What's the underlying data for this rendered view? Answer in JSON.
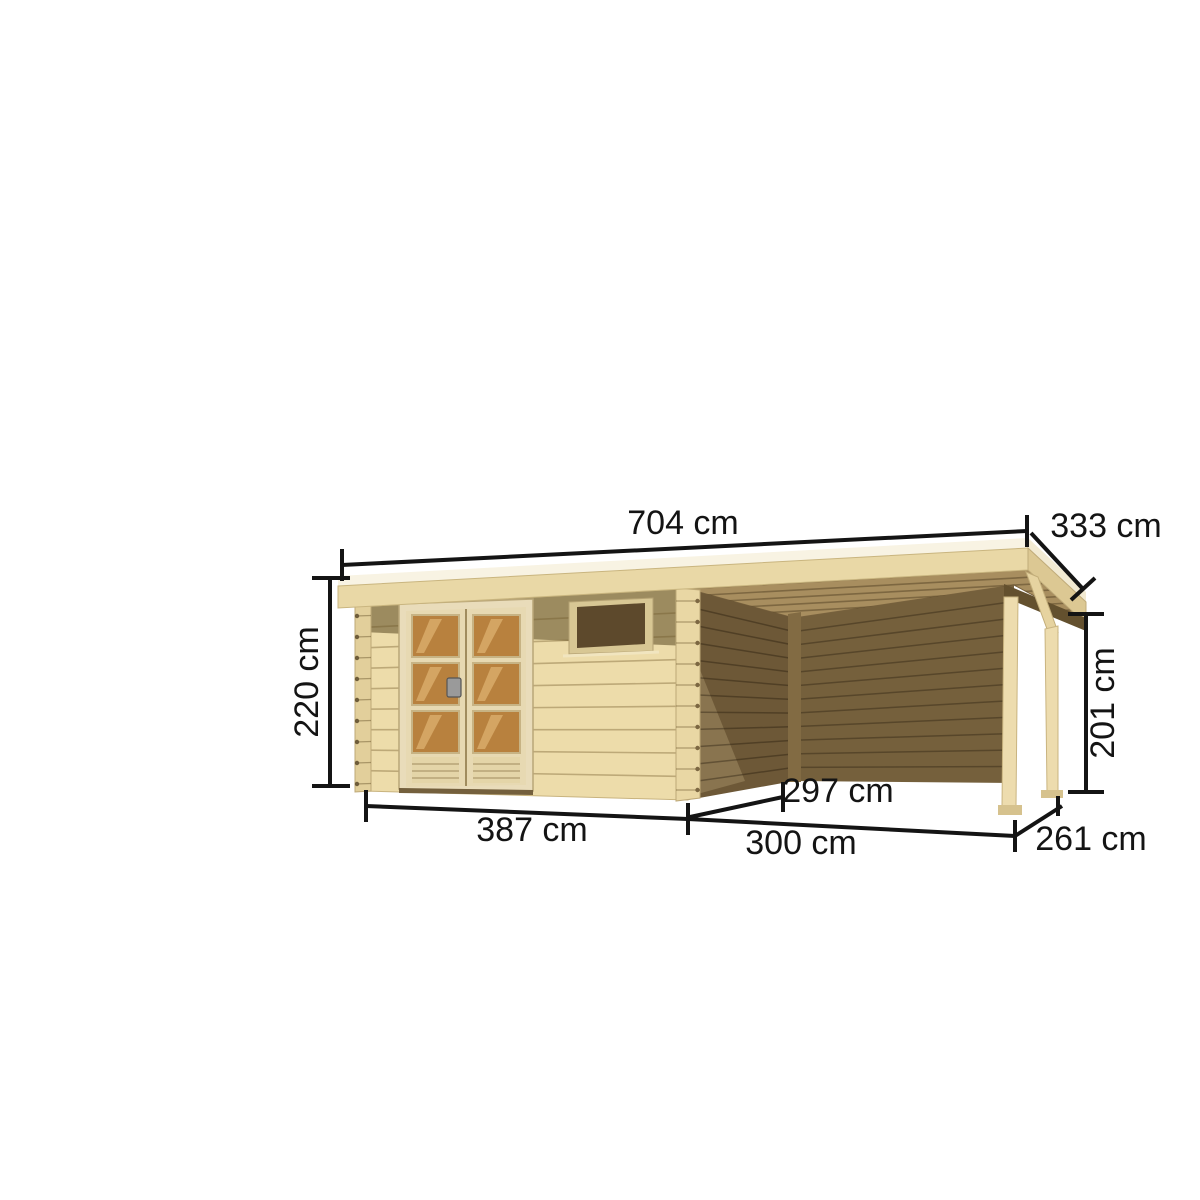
{
  "figure": {
    "type": "product-dimension-diagram",
    "subject": "wooden garden shed with pent roof, double glazed door, small window and attached open side canopy on two posts",
    "background_color": "#ffffff",
    "annotation_color": "#141414"
  },
  "dimensions": {
    "roof_width": "704 cm",
    "roof_depth": "333 cm",
    "wall_height": "220 cm",
    "canopy_height": "201 cm",
    "canopy_inner_depth": "297 cm",
    "shed_width": "387 cm",
    "canopy_width": "300 cm",
    "canopy_depth": "261 cm"
  },
  "colors": {
    "roof_top": "#f8f3e3",
    "roof_fascia": "#e9d8a6",
    "roof_fascia_side": "#dcc893",
    "front_wall": "#eddcaa",
    "eave_shadow": "#9c8b5f",
    "door_frame": "#e9dcba",
    "door_glass": "#b8813e",
    "window_opening": "#5d492c",
    "side_wall_dark": "#6d5837",
    "back_wall_dark": "#75603c",
    "ceiling": "#a88e5f",
    "beam_dark": "#63502e",
    "post": "#eddcae"
  }
}
